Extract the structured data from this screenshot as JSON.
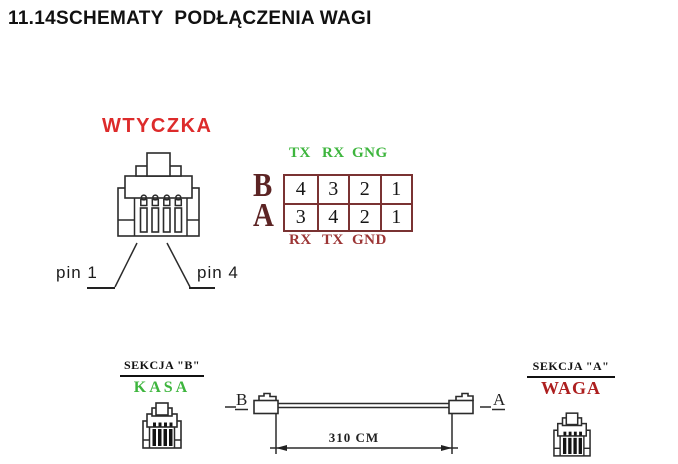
{
  "title": "11.14SCHEMATY  PODŁĄCZENIA WAGI",
  "plug_diagram": {
    "label": "WTYCZKA",
    "pin_left_label": "pin 1",
    "pin_right_label": "pin 4"
  },
  "pin_table": {
    "top_header": [
      "TX",
      "RX",
      "GNG"
    ],
    "bottom_header": [
      "RX",
      "TX",
      "GND"
    ],
    "row_labels": [
      "B",
      "A"
    ],
    "rows": [
      [
        "4",
        "3",
        "2",
        "1"
      ],
      [
        "3",
        "4",
        "2",
        "1"
      ]
    ]
  },
  "cable_diagram": {
    "left_end_label": "B",
    "right_end_label": "A",
    "length_label": "310 CM"
  },
  "section_left": {
    "title": "SEKCJA \"B\"",
    "name": "KASA"
  },
  "section_right": {
    "title": "SEKCJA \"A\"",
    "name": "WAGA"
  },
  "colors": {
    "plug_label_red": "#dd2b2b",
    "green_text": "#3db53d",
    "footer_maroon": "#9c3535",
    "table_border": "#7a3232",
    "row_label_maroon": "#5c2424",
    "waga_red": "#ad1f1f",
    "line": "#2b2b2b"
  }
}
